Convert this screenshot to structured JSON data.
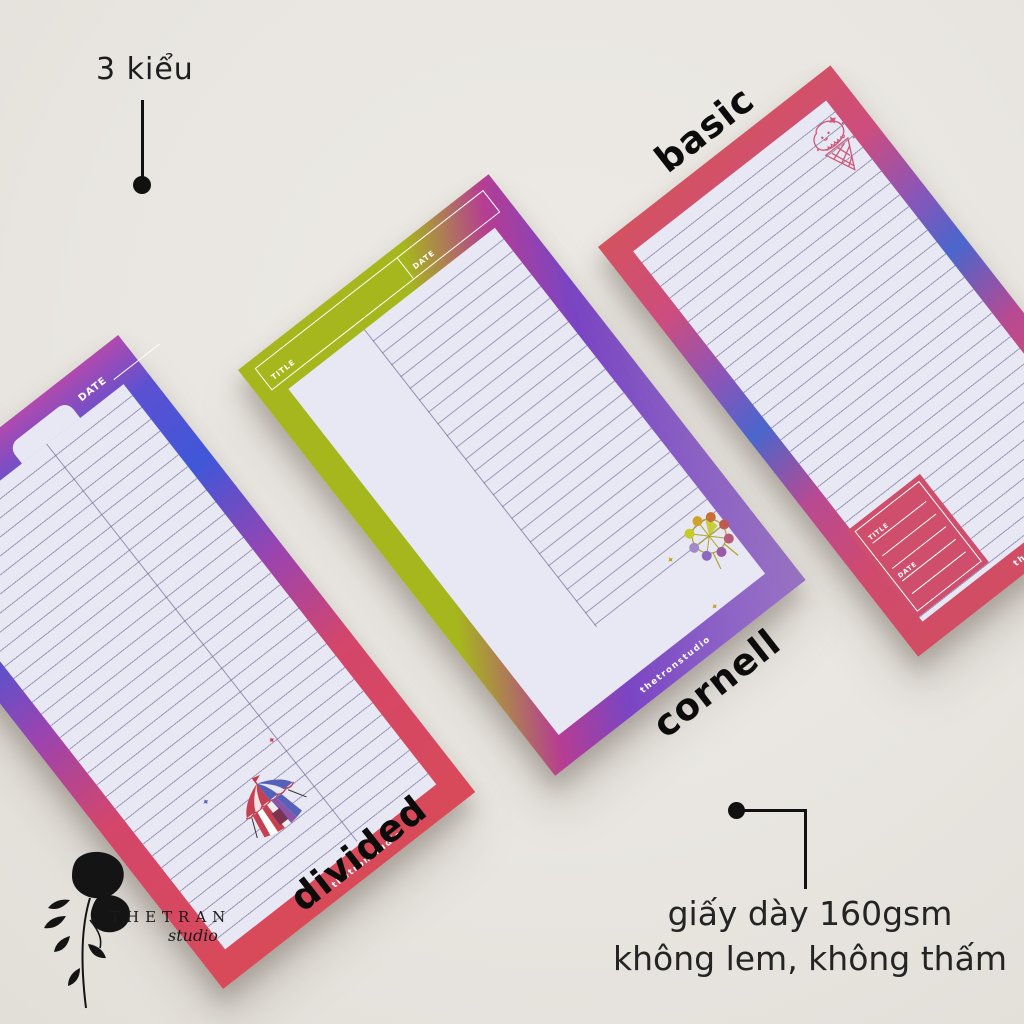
{
  "annotations": {
    "styles_count": "3 kiểu",
    "paper_info_line1": "giấy dày 160gsm",
    "paper_info_line2": "không lem, không thấm"
  },
  "brand": {
    "name": "THETRAN",
    "sub": "studio"
  },
  "pads": {
    "divided": {
      "label": "divided",
      "date_label": "DATE",
      "watermark": "thetronstudio",
      "illustration": "circus-tent",
      "border_colors": [
        "#b04aae",
        "#3f57d8",
        "#9a44b0",
        "#d84a58"
      ]
    },
    "cornell": {
      "label": "cornell",
      "title_label": "TITLE",
      "date_label": "DATE",
      "watermark": "thetronstudio",
      "illustration": "ferris-wheel",
      "border_colors": [
        "#a6b71d",
        "#b63d92",
        "#7a45c4",
        "#9a74c4"
      ]
    },
    "basic": {
      "label": "basic",
      "title_label": "TITLE",
      "date_label": "DATE",
      "watermark": "thetronstudio",
      "illustration": "ice-cream",
      "border_colors": [
        "#d4525f",
        "#4a66cc",
        "#d14e60"
      ]
    }
  },
  "paper_color": "#e8e7f4",
  "background_color": "#e9e6e1"
}
